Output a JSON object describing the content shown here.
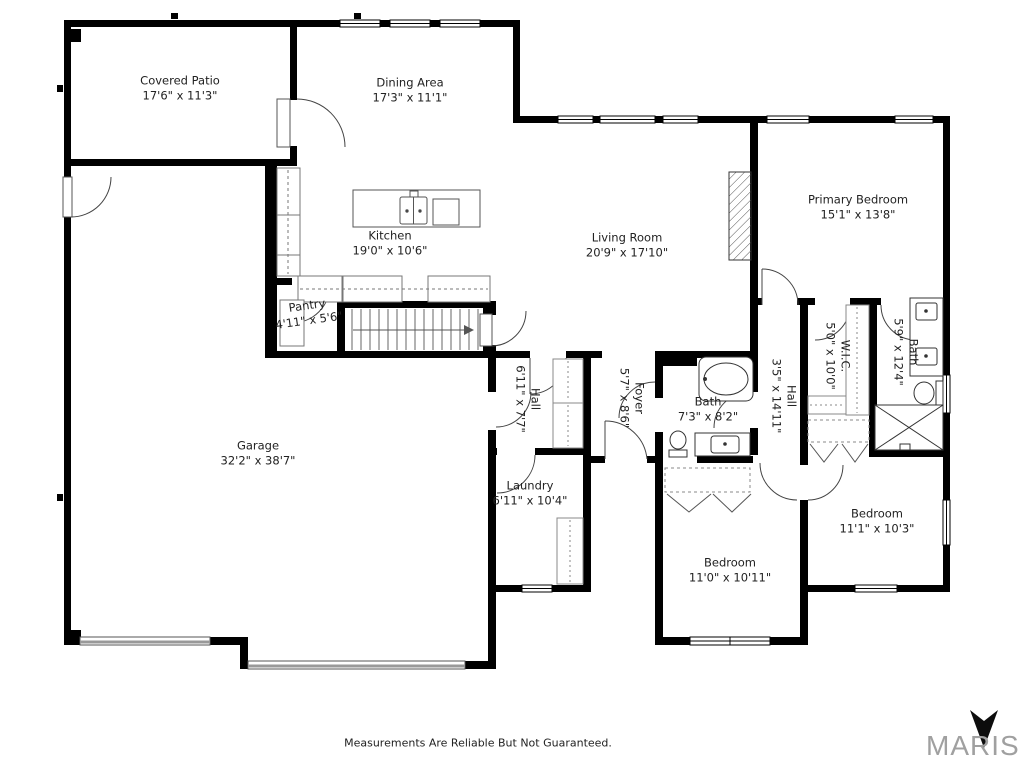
{
  "floorplan": {
    "rooms": [
      {
        "name": "Covered Patio",
        "dims": "17'6\" x 11'3\""
      },
      {
        "name": "Dining Area",
        "dims": "17'3\" x 11'1\""
      },
      {
        "name": "Kitchen",
        "dims": "19'0\" x 10'6\""
      },
      {
        "name": "Pantry",
        "dims": "4'11\" x 5'6\""
      },
      {
        "name": "Living Room",
        "dims": "20'9\" x 17'10\""
      },
      {
        "name": "Primary Bedroom",
        "dims": "15'1\" x 13'8\""
      },
      {
        "name": "Garage",
        "dims": "32'2\" x 38'7\""
      },
      {
        "name": "Hall",
        "dims": "6'11\" x 7'7\""
      },
      {
        "name": "Foyer",
        "dims": "5'7\" x 8'6\""
      },
      {
        "name": "Bath",
        "dims": "7'3\" x 8'2\""
      },
      {
        "name": "Hall",
        "dims": "3'5\" x 14'11\""
      },
      {
        "name": "W.I.C.",
        "dims": "5'0\" x 10'0\""
      },
      {
        "name": "Bath",
        "dims": "5'9\" x 12'4\""
      },
      {
        "name": "Laundry",
        "dims": "6'11\" x 10'4\""
      },
      {
        "name": "Bedroom",
        "dims": "11'0\" x 10'11\""
      },
      {
        "name": "Bedroom",
        "dims": "11'1\" x 10'3\""
      }
    ],
    "footer": {
      "disclaimer": "Measurements Are Reliable But Not Guaranteed.",
      "brand": "MARIS",
      "brand_arrow_icon": "down-dart"
    },
    "colors": {
      "walls": "#000000",
      "text": "#222222",
      "brand_text": "#a0a0a0"
    }
  }
}
